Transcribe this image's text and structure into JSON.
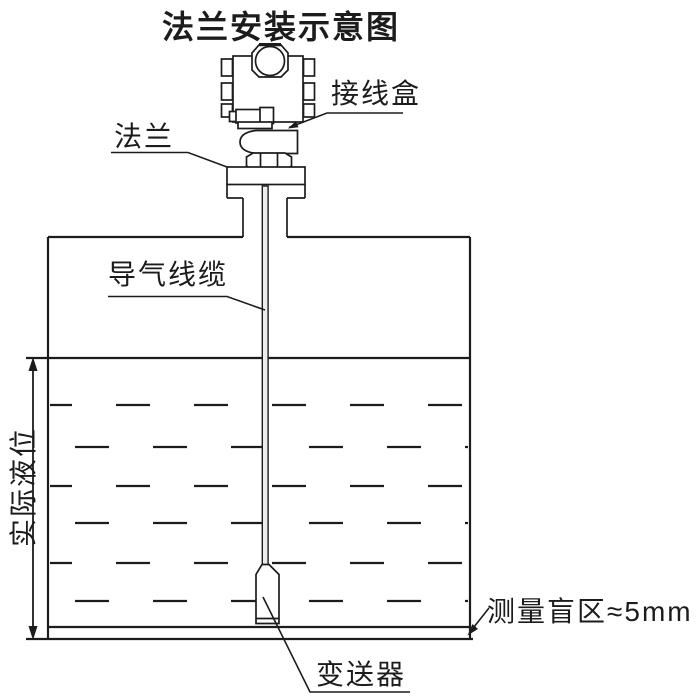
{
  "title": "法兰安装示意图",
  "labels": {
    "junction_box": "接线盒",
    "flange": "法兰",
    "air_cable": "导气线缆",
    "actual_level": "实际液位",
    "blind_zone": "测量盲区≈5mm",
    "transmitter": "变送器"
  },
  "colors": {
    "line": "#1c1c1c",
    "background": "#ffffff",
    "cable_fill": "#ececec"
  }
}
